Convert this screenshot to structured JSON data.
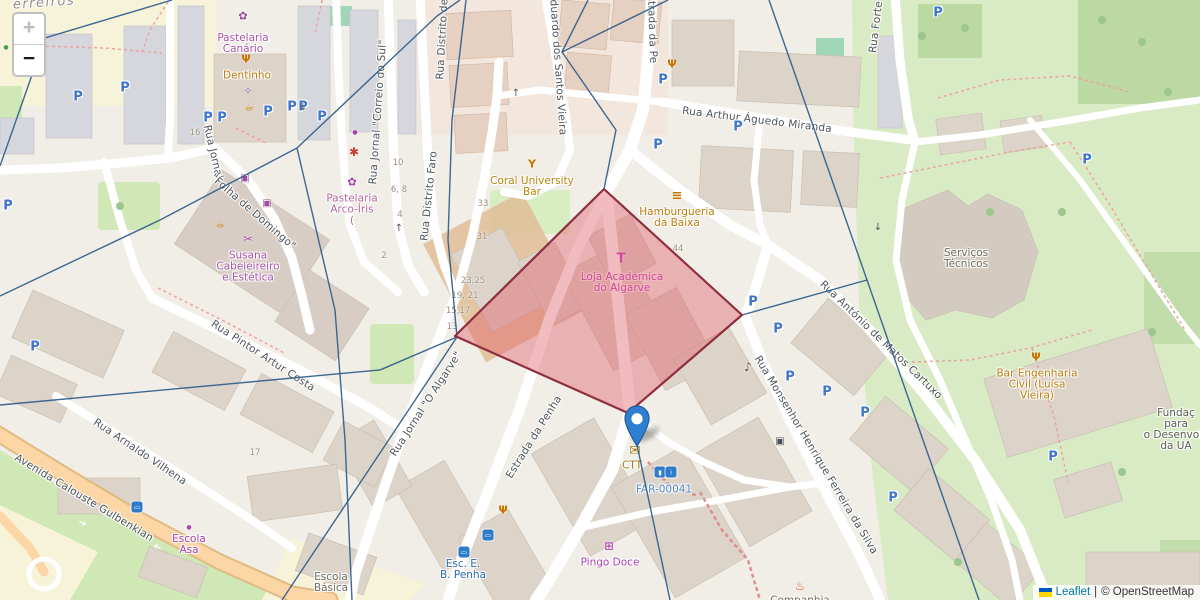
{
  "zoom_control": {
    "zoom_in_label": "+",
    "zoom_out_label": "−"
  },
  "attribution": {
    "leaflet_link": "Leaflet",
    "separator": "|",
    "osm_credit": "© OpenStreetMap",
    "flag_colors": [
      "#005BBB",
      "#FFD500"
    ]
  },
  "map": {
    "street_labels": [
      {
        "text": "erreiros",
        "x": 44,
        "y": 3,
        "rot": -4,
        "kind": "locality"
      },
      {
        "text": "Rua Jornal",
        "x": 213,
        "y": 152,
        "rot": 77
      },
      {
        "text": "\"Folha de Domingo\"",
        "x": 253,
        "y": 212,
        "rot": 41
      },
      {
        "text": "Rua Jornal \"Correio do Sul\"",
        "x": 378,
        "y": 112,
        "rot": -86
      },
      {
        "text": "Rua Distrito de Faro",
        "x": 443,
        "y": 26,
        "rot": -87
      },
      {
        "text": "Rua Distrito Faro",
        "x": 429,
        "y": 196,
        "rot": -84
      },
      {
        "text": "Rua Eduardo dos Santos Vieira",
        "x": 557,
        "y": 52,
        "rot": 86
      },
      {
        "text": "Estrada da Pe",
        "x": 652,
        "y": 26,
        "rot": 88
      },
      {
        "text": "Rua Arthur Águedo Miranda",
        "x": 757,
        "y": 120,
        "rot": 7
      },
      {
        "text": "Rua Forte",
        "x": 876,
        "y": 27,
        "rot": -83
      },
      {
        "text": "Rua Pintor Artur Costa",
        "x": 263,
        "y": 356,
        "rot": 33
      },
      {
        "text": "Rua Arnaldo Vilhena",
        "x": 140,
        "y": 452,
        "rot": 34
      },
      {
        "text": "Avenida Calouste Gulbenkian",
        "x": 84,
        "y": 498,
        "rot": 31
      },
      {
        "text": "Rua Jornal \"O Algarve\"",
        "x": 426,
        "y": 404,
        "rot": -57
      },
      {
        "text": "Estrada da Penha",
        "x": 534,
        "y": 437,
        "rot": -58
      },
      {
        "text": "Rua António de Matos Cartuxo",
        "x": 881,
        "y": 340,
        "rot": 44
      },
      {
        "text": "Rua Monsenhor Henrique Ferreira da Silva",
        "x": 816,
        "y": 455,
        "rot": 59
      }
    ],
    "poi_labels": [
      {
        "name": "pastelaria-canario",
        "lines": [
          "Pastelaria",
          "Canário"
        ],
        "x": 243,
        "y": 44,
        "color": "#a955a9"
      },
      {
        "name": "dentinho",
        "lines": [
          "Dentinho"
        ],
        "x": 247,
        "y": 76,
        "color": "#bb7d0e"
      },
      {
        "name": "pastelaria-arco-iris",
        "lines": [
          "Pastelaria",
          "Arco-Íris",
          "("
        ],
        "x": 352,
        "y": 210,
        "color": "#b5679c"
      },
      {
        "name": "susana-cabeleireiro",
        "lines": [
          "Susana",
          "Cabeleireiro",
          "e Estética"
        ],
        "x": 248,
        "y": 267,
        "color": "#a955a9"
      },
      {
        "name": "coral-university-bar",
        "lines": [
          "Coral University",
          "Bar"
        ],
        "x": 532,
        "y": 187,
        "color": "#b8860b"
      },
      {
        "name": "hamburgueria-da-baixa",
        "lines": [
          "Hamburgueria",
          "da Baixa"
        ],
        "x": 677,
        "y": 218,
        "color": "#bb7d0e"
      },
      {
        "name": "loja-academica-do-algarve",
        "lines": [
          "Loja Académica",
          "do Algarve"
        ],
        "x": 622,
        "y": 283,
        "color": "#bb3eb5"
      },
      {
        "name": "servicos-tecnicos",
        "lines": [
          "Serviços",
          "Técnicos"
        ],
        "x": 966,
        "y": 259,
        "color": "#6f7063"
      },
      {
        "name": "bar-engenharia-civil",
        "lines": [
          "Bar Engenharia",
          "Civil (Luísa",
          "Vieira)"
        ],
        "x": 1037,
        "y": 385,
        "color": "#bb7d0e"
      },
      {
        "name": "fundacao-ua",
        "lines": [
          "Fundaç",
          "para",
          "o Desenvolv",
          "da UA"
        ],
        "x": 1176,
        "y": 430,
        "color": "#5d5e55"
      },
      {
        "name": "escola-asa",
        "lines": [
          "Escola",
          "Asa"
        ],
        "x": 189,
        "y": 545,
        "color": "#ad43b0"
      },
      {
        "name": "escola-basica",
        "lines": [
          "Escola",
          "Básica"
        ],
        "x": 331,
        "y": 583,
        "color": "#6f7063"
      },
      {
        "name": "esc-eb-penha",
        "lines": [
          "Esc. E.",
          "B. Penha"
        ],
        "x": 463,
        "y": 570,
        "color": "#2a6cb5"
      },
      {
        "name": "pingo-doce",
        "lines": [
          "Pingo Doce"
        ],
        "x": 610,
        "y": 563,
        "color": "#ad43b0"
      },
      {
        "name": "ctt",
        "lines": [
          "CTT"
        ],
        "x": 632,
        "y": 466,
        "color": "#9c7a12"
      },
      {
        "name": "far-00041",
        "lines": [
          "FAR-00041"
        ],
        "x": 664,
        "y": 490,
        "color": "#4d82c3"
      },
      {
        "name": "companhia",
        "lines": [
          "Companhia"
        ],
        "x": 800,
        "y": 601,
        "color": "#6f7063"
      }
    ],
    "poi_icons": [
      {
        "name": "cupcake-icon",
        "glyph": "✿",
        "x": 243,
        "y": 16,
        "color": "#a03fa5",
        "size": 11
      },
      {
        "name": "restaurant-icon",
        "glyph": "Ψ",
        "x": 246,
        "y": 59,
        "color": "#c77400",
        "size": 11,
        "bold": true
      },
      {
        "name": "dentist-icon",
        "glyph": "✧",
        "x": 248,
        "y": 91,
        "color": "#9a6ab5",
        "size": 11,
        "bold": true
      },
      {
        "name": "cafe-icon",
        "glyph": "☕",
        "x": 249,
        "y": 107,
        "color": "#c77400",
        "size": 11
      },
      {
        "name": "laundry-icon",
        "glyph": "▣",
        "x": 245,
        "y": 179,
        "color": "#9c4f9c",
        "size": 10
      },
      {
        "name": "shop-icon",
        "glyph": "▣",
        "x": 267,
        "y": 204,
        "color": "#9c4f9c",
        "size": 10
      },
      {
        "name": "shop-dot-icon",
        "glyph": "●",
        "x": 355,
        "y": 133,
        "color": "#a03fa5",
        "size": 6
      },
      {
        "name": "pet-paw-icon",
        "glyph": "✱",
        "x": 354,
        "y": 152,
        "color": "#cc3b30",
        "size": 12,
        "bold": true
      },
      {
        "name": "cupcake-icon",
        "glyph": "✿",
        "x": 352,
        "y": 182,
        "color": "#a03fa5",
        "size": 11
      },
      {
        "name": "hairdresser-scissors-icon",
        "glyph": "✂",
        "x": 248,
        "y": 239,
        "color": "#a955a9",
        "size": 12
      },
      {
        "name": "cafe-icon",
        "glyph": "☕",
        "x": 220,
        "y": 224,
        "color": "#c77400",
        "size": 11
      },
      {
        "name": "cocktail-icon",
        "glyph": "Y",
        "x": 532,
        "y": 164,
        "color": "#c77400",
        "size": 11,
        "bold": true
      },
      {
        "name": "burger-icon",
        "glyph": "≡",
        "x": 677,
        "y": 196,
        "color": "#c77400",
        "size": 13,
        "bold": true
      },
      {
        "name": "tshirt-icon",
        "glyph": "T",
        "x": 621,
        "y": 259,
        "color": "#c43ec4",
        "size": 13,
        "bold": true
      },
      {
        "name": "restaurant-icon",
        "glyph": "Ψ",
        "x": 672,
        "y": 64,
        "color": "#c77400",
        "size": 11,
        "bold": true
      },
      {
        "name": "restaurant-icon",
        "glyph": "Ψ",
        "x": 503,
        "y": 510,
        "color": "#c77400",
        "size": 11,
        "bold": true
      },
      {
        "name": "restaurant-icon",
        "glyph": "Ψ",
        "x": 1036,
        "y": 357,
        "color": "#c77400",
        "size": 11,
        "bold": true
      },
      {
        "name": "cart-icon",
        "glyph": "⊞",
        "x": 609,
        "y": 546,
        "color": "#ad43b0",
        "size": 11,
        "bold": true
      },
      {
        "name": "post-envelope-icon",
        "glyph": "✉",
        "x": 635,
        "y": 451,
        "color": "#a7801c",
        "size": 14,
        "bold": true
      },
      {
        "name": "fire-station-icon",
        "glyph": "♨",
        "x": 800,
        "y": 586,
        "color": "#e06010",
        "size": 12,
        "bold": true
      },
      {
        "name": "music-shop-icon",
        "glyph": "♪",
        "x": 748,
        "y": 367,
        "color": "#7a5230",
        "size": 12,
        "bold": true
      },
      {
        "name": "atm-icon",
        "glyph": "▣",
        "x": 780,
        "y": 442,
        "color": "#4a4f58",
        "size": 10
      },
      {
        "name": "school-dot-icon",
        "glyph": "●",
        "x": 189,
        "y": 528,
        "color": "#ad43b0",
        "size": 6
      },
      {
        "name": "green-poi-icon",
        "glyph": "●",
        "x": 6,
        "y": 48,
        "color": "#43a047",
        "size": 6
      }
    ],
    "transit_chips": [
      {
        "name": "bus-stop-icon",
        "glyph": "▭",
        "x": 137,
        "y": 507
      },
      {
        "name": "bus-stop-icon",
        "glyph": "▭",
        "x": 464,
        "y": 552
      },
      {
        "name": "bus-stop-icon",
        "glyph": "▭",
        "x": 488,
        "y": 535
      },
      {
        "name": "toilets-icon",
        "glyph": "▮",
        "x": 660,
        "y": 472
      },
      {
        "name": "info-icon",
        "glyph": "i",
        "x": 671,
        "y": 472
      }
    ],
    "house_numbers": [
      {
        "text": "16",
        "x": 195,
        "y": 133
      },
      {
        "text": "10",
        "x": 398,
        "y": 163
      },
      {
        "text": "6, 8",
        "x": 399,
        "y": 190
      },
      {
        "text": "4",
        "x": 400,
        "y": 215
      },
      {
        "text": "33",
        "x": 483,
        "y": 204
      },
      {
        "text": "31",
        "x": 482,
        "y": 237
      },
      {
        "text": "23,25",
        "x": 473,
        "y": 281
      },
      {
        "text": "19, 21",
        "x": 465,
        "y": 296
      },
      {
        "text": "15,17",
        "x": 458,
        "y": 311
      },
      {
        "text": "13",
        "x": 452,
        "y": 327
      },
      {
        "text": "2",
        "x": 384,
        "y": 256
      },
      {
        "text": "44",
        "x": 678,
        "y": 249
      },
      {
        "text": "17",
        "x": 255,
        "y": 453
      }
    ],
    "parking": {
      "glyph": "P",
      "color": "#3e74cc",
      "positions": [
        [
          78,
          97
        ],
        [
          125,
          88
        ],
        [
          208,
          118
        ],
        [
          222,
          118
        ],
        [
          268,
          112
        ],
        [
          292,
          107
        ],
        [
          303,
          107
        ],
        [
          322,
          117
        ],
        [
          663,
          80
        ],
        [
          658,
          145
        ],
        [
          738,
          127
        ],
        [
          753,
          302
        ],
        [
          778,
          329
        ],
        [
          790,
          377
        ],
        [
          827,
          392
        ],
        [
          865,
          413
        ],
        [
          893,
          498
        ],
        [
          1087,
          160
        ],
        [
          1053,
          457
        ],
        [
          35,
          347
        ],
        [
          8,
          206
        ],
        [
          938,
          13
        ]
      ]
    },
    "arrows": [
      {
        "glyph": "↑",
        "x": 399,
        "y": 229,
        "rot": 0,
        "color": "#555"
      },
      {
        "glyph": "↓",
        "x": 303,
        "y": 108,
        "rot": 0,
        "color": "#555"
      },
      {
        "glyph": "↑",
        "x": 516,
        "y": 94,
        "rot": 0,
        "color": "#555"
      },
      {
        "glyph": "↓",
        "x": 878,
        "y": 228,
        "rot": 0,
        "color": "#555"
      },
      {
        "glyph": "➔",
        "x": 82,
        "y": 524,
        "rot": 30,
        "color": "#ffffff"
      },
      {
        "glyph": "➔",
        "x": 158,
        "y": 546,
        "rot": 210,
        "color": "#ffffff"
      }
    ],
    "overlays": {
      "selection_points": "604,189 742,315 628,413 455,336",
      "selection_fill": "#e05c68",
      "selection_stroke": "#8e2e3e",
      "line_color": "#33608c",
      "boundary_lines": [
        "172,0 45,38 0,166",
        "460,0 437,16 297,148 335,310 345,440 352,600",
        "0,296 160,220 297,148",
        "0,405 380,370 457,337",
        "466,0 452,120 448,240 457,337",
        "588,0 562,52 616,130 604,189",
        "668,0 562,52",
        "457,337 380,453 282,600",
        "630,412 670,600",
        "769,0 867,280 979,600",
        "742,315 867,280"
      ]
    }
  }
}
